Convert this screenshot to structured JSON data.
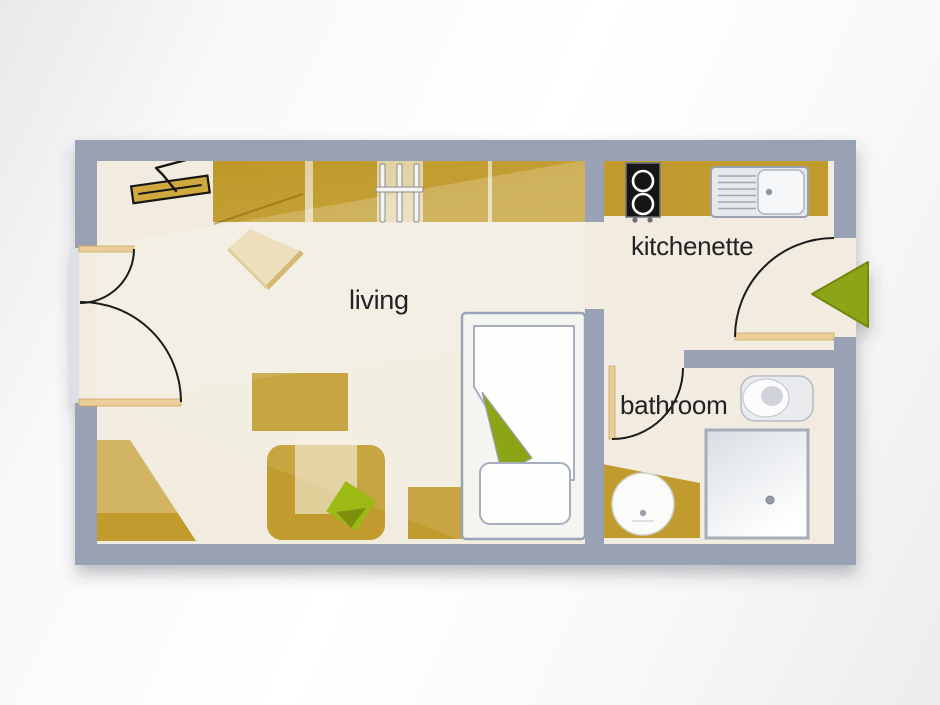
{
  "plan": {
    "rooms": {
      "living": {
        "label": "living"
      },
      "kitchenette": {
        "label": "kitchenette"
      },
      "bathroom": {
        "label": "bathroom"
      }
    },
    "colors": {
      "wall": "#98a2b4",
      "floor": "#f1ecdf",
      "furniture_ochre": "#c19b2e",
      "accent_green": "#8ca513",
      "cushion_green": "#9cb917",
      "door_leaf_tan": "#ecce98",
      "table_tan": "#e9d7ac",
      "label_text": "#222226"
    }
  }
}
